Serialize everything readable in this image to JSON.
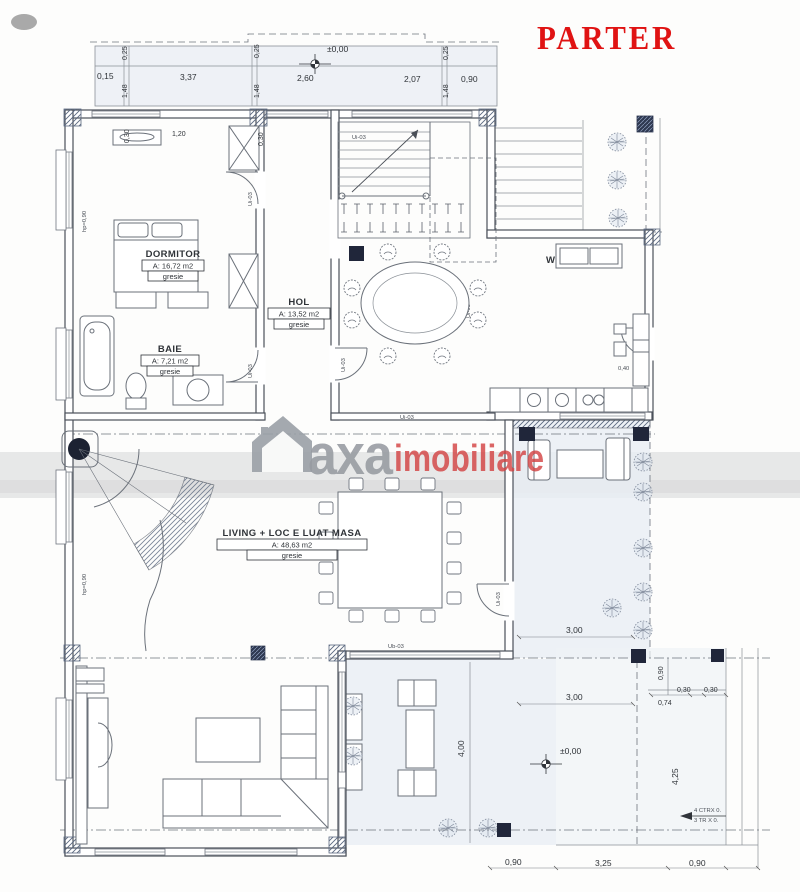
{
  "title": {
    "label": "PARTER",
    "color": "#e01313"
  },
  "watermark": {
    "brand_gray": "axa",
    "brand_red": "imobiliare"
  },
  "rooms": [
    {
      "name": "DORMITOR",
      "area": "A: 16,72 m2",
      "finish": "gresie"
    },
    {
      "name": "BAIE",
      "area": "A: 7,21 m2",
      "finish": "gresie"
    },
    {
      "name": "HOL",
      "area": "A: 13,52 m2",
      "finish": "gresie"
    },
    {
      "name": "LIVING + LOC E LUAT MASA",
      "area": "A: 48,63 m2",
      "finish": "gresie"
    }
  ],
  "labels": {
    "kitchen_mark": "W",
    "door_ui": "Ui-03",
    "door_ub": "Ub-03",
    "sill_height": "hp=0,90",
    "level_zero": "±0,00",
    "stair_note_line1": "4 CTRX 0.",
    "stair_note_line2": "3 TR X 0."
  },
  "dims": {
    "d015": "0,15",
    "d025": "0,25",
    "d030": "0,30",
    "d040": "0,40",
    "d074": "0,74",
    "d090": "0,90",
    "d120": "1,20",
    "d148": "1,48",
    "d207": "2,07",
    "d260": "2,60",
    "d300": "3,00",
    "d325": "3,25",
    "d337": "3,37",
    "d400": "4,00",
    "d425": "4,25"
  }
}
